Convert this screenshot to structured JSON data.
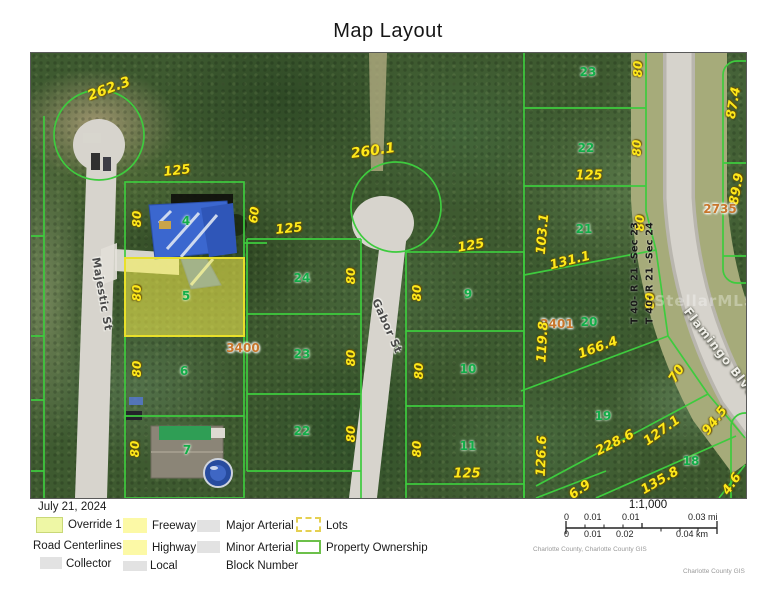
{
  "title": "Map Layout",
  "map": {
    "labels": [
      {
        "t": "262.3",
        "x": 78,
        "y": 36,
        "r": -20,
        "c": "dim",
        "s": 14
      },
      {
        "t": "125",
        "x": 146,
        "y": 118,
        "r": -6,
        "c": "dim",
        "s": 13
      },
      {
        "t": "80",
        "x": 106,
        "y": 166,
        "r": -90,
        "c": "dim"
      },
      {
        "t": "60",
        "x": 223,
        "y": 162,
        "r": -83,
        "c": "dim"
      },
      {
        "t": "4",
        "x": 155,
        "y": 168,
        "r": 0,
        "c": "parcel"
      },
      {
        "t": "80",
        "x": 106,
        "y": 240,
        "r": -90,
        "c": "dim"
      },
      {
        "t": "5",
        "x": 155,
        "y": 243,
        "r": 0,
        "c": "parcel"
      },
      {
        "t": "3400",
        "x": 212,
        "y": 295,
        "r": 0,
        "c": "block"
      },
      {
        "t": "80",
        "x": 106,
        "y": 316,
        "r": -90,
        "c": "dim"
      },
      {
        "t": "6",
        "x": 153,
        "y": 318,
        "r": 0,
        "c": "parcel"
      },
      {
        "t": "80",
        "x": 104,
        "y": 396,
        "r": -90,
        "c": "dim"
      },
      {
        "t": "7",
        "x": 156,
        "y": 397,
        "r": 0,
        "c": "parcel"
      },
      {
        "t": "260.1",
        "x": 342,
        "y": 98,
        "r": -8,
        "c": "dim",
        "s": 14
      },
      {
        "t": "125",
        "x": 258,
        "y": 176,
        "r": -6,
        "c": "dim",
        "s": 13
      },
      {
        "t": "24",
        "x": 271,
        "y": 225,
        "r": 0,
        "c": "parcel"
      },
      {
        "t": "80",
        "x": 320,
        "y": 223,
        "r": -90,
        "c": "dim"
      },
      {
        "t": "23",
        "x": 271,
        "y": 301,
        "r": 0,
        "c": "parcel"
      },
      {
        "t": "80",
        "x": 320,
        "y": 305,
        "r": -90,
        "c": "dim"
      },
      {
        "t": "22",
        "x": 271,
        "y": 378,
        "r": 0,
        "c": "parcel"
      },
      {
        "t": "80",
        "x": 320,
        "y": 381,
        "r": -90,
        "c": "dim"
      },
      {
        "t": "125",
        "x": 440,
        "y": 193,
        "r": -10,
        "c": "dim",
        "s": 13
      },
      {
        "t": "9",
        "x": 437,
        "y": 241,
        "r": 0,
        "c": "parcel"
      },
      {
        "t": "80",
        "x": 386,
        "y": 240,
        "r": -90,
        "c": "dim"
      },
      {
        "t": "10",
        "x": 437,
        "y": 316,
        "r": 0,
        "c": "parcel"
      },
      {
        "t": "80",
        "x": 388,
        "y": 318,
        "r": -90,
        "c": "dim"
      },
      {
        "t": "11",
        "x": 437,
        "y": 393,
        "r": 0,
        "c": "parcel"
      },
      {
        "t": "80",
        "x": 386,
        "y": 396,
        "r": -90,
        "c": "dim"
      },
      {
        "t": "125",
        "x": 436,
        "y": 421,
        "r": 0,
        "c": "dim",
        "s": 13
      },
      {
        "t": "23",
        "x": 557,
        "y": 19,
        "r": 0,
        "c": "parcel"
      },
      {
        "t": "80",
        "x": 607,
        "y": 16,
        "r": -90,
        "c": "dim"
      },
      {
        "t": "22",
        "x": 555,
        "y": 95,
        "r": 0,
        "c": "parcel"
      },
      {
        "t": "80",
        "x": 606,
        "y": 95,
        "r": -90,
        "c": "dim"
      },
      {
        "t": "125",
        "x": 558,
        "y": 123,
        "r": 0,
        "c": "dim",
        "s": 13
      },
      {
        "t": "21",
        "x": 553,
        "y": 176,
        "r": 0,
        "c": "parcel"
      },
      {
        "t": "103.1",
        "x": 512,
        "y": 181,
        "r": -85,
        "c": "dim",
        "s": 13
      },
      {
        "t": "131.1",
        "x": 539,
        "y": 208,
        "r": -14,
        "c": "dim",
        "s": 13
      },
      {
        "t": "80",
        "x": 609,
        "y": 170,
        "r": -90,
        "c": "dim"
      },
      {
        "t": "80",
        "x": 619,
        "y": 248,
        "r": -90,
        "c": "dim"
      },
      {
        "t": "20",
        "x": 558,
        "y": 269,
        "r": 0,
        "c": "parcel"
      },
      {
        "t": "3401",
        "x": 526,
        "y": 271,
        "r": 0,
        "c": "block"
      },
      {
        "t": "119.8",
        "x": 512,
        "y": 289,
        "r": -87,
        "c": "dim",
        "s": 13
      },
      {
        "t": "166.4",
        "x": 567,
        "y": 295,
        "r": -20,
        "c": "dim",
        "s": 13
      },
      {
        "t": "70",
        "x": 646,
        "y": 321,
        "r": -58,
        "c": "dim",
        "s": 13
      },
      {
        "t": "19",
        "x": 572,
        "y": 363,
        "r": 0,
        "c": "parcel"
      },
      {
        "t": "126.6",
        "x": 511,
        "y": 403,
        "r": -88,
        "c": "dim",
        "s": 13
      },
      {
        "t": "228.6",
        "x": 584,
        "y": 390,
        "r": -27,
        "c": "dim",
        "s": 13
      },
      {
        "t": "127.1",
        "x": 631,
        "y": 378,
        "r": -36,
        "c": "dim",
        "s": 13
      },
      {
        "t": "94.5",
        "x": 684,
        "y": 368,
        "r": -52,
        "c": "dim",
        "s": 13
      },
      {
        "t": "18",
        "x": 660,
        "y": 408,
        "r": 0,
        "c": "parcel"
      },
      {
        "t": "135.8",
        "x": 629,
        "y": 428,
        "r": -30,
        "c": "dim",
        "s": 13
      },
      {
        "t": "6.9",
        "x": 549,
        "y": 437,
        "r": -35,
        "c": "dim",
        "s": 13
      },
      {
        "t": "4.6",
        "x": 701,
        "y": 431,
        "r": -55,
        "c": "dim",
        "s": 13
      },
      {
        "t": "87.4",
        "x": 703,
        "y": 50,
        "r": -80,
        "c": "dim",
        "s": 13
      },
      {
        "t": "89.9",
        "x": 706,
        "y": 136,
        "r": -80,
        "c": "dim",
        "s": 13
      },
      {
        "t": "2735",
        "x": 689,
        "y": 156,
        "r": 0,
        "c": "block"
      },
      {
        "t": "Majestic St",
        "x": 71,
        "y": 241,
        "r": 80,
        "c": "street"
      },
      {
        "t": "Gabor St",
        "x": 356,
        "y": 273,
        "r": 66,
        "c": "street"
      },
      {
        "t": "Flamingo Blvd",
        "x": 689,
        "y": 299,
        "r": 52,
        "c": "flamingo"
      },
      {
        "t": "T 40- R 21 -Sec 23",
        "x": 604,
        "y": 220,
        "r": -90,
        "c": "section"
      },
      {
        "t": "T 40- R 21 -Sec 24",
        "x": 619,
        "y": 220,
        "r": -90,
        "c": "section"
      },
      {
        "t": "StellarMLS",
        "x": 674,
        "y": 248,
        "r": 0,
        "c": "wm"
      }
    ]
  },
  "legend": {
    "date": "July 21, 2024",
    "heading": "Road Centerlines",
    "items": [
      {
        "label": "Override 1",
        "sw": "override",
        "sx": 36,
        "sy": 517,
        "w": 27,
        "h": 16,
        "lx": 68,
        "ly": 519
      },
      {
        "label": "Freeway",
        "sw": "yellow",
        "sx": 123,
        "sy": 518,
        "w": 24,
        "h": 15,
        "lx": 152,
        "ly": 520
      },
      {
        "label": "Major Arterial",
        "sw": "gray",
        "sx": 197,
        "sy": 520,
        "w": 23,
        "h": 12,
        "lx": 226,
        "ly": 520
      },
      {
        "label": "Lots",
        "sw": "lots",
        "sx": 296,
        "sy": 517,
        "w": 25,
        "h": 15,
        "lx": 326,
        "ly": 520
      },
      {
        "label": "Highway",
        "sw": "yellow",
        "sx": 123,
        "sy": 540,
        "w": 24,
        "h": 15,
        "lx": 152,
        "ly": 542
      },
      {
        "label": "Minor Arterial",
        "sw": "gray",
        "sx": 197,
        "sy": 541,
        "w": 23,
        "h": 12,
        "lx": 226,
        "ly": 542
      },
      {
        "label": "Property Ownership",
        "sw": "ownership",
        "sx": 296,
        "sy": 540,
        "w": 25,
        "h": 14,
        "lx": 326,
        "ly": 542
      },
      {
        "label": "Collector",
        "sw": "gray",
        "sx": 40,
        "sy": 557,
        "w": 22,
        "h": 12,
        "lx": 66,
        "ly": 558
      },
      {
        "label": "Local",
        "sw": "gray",
        "sx": 123,
        "sy": 561,
        "w": 24,
        "h": 10,
        "lx": 150,
        "ly": 560
      },
      {
        "label": "Block Number",
        "sw": "none",
        "sx": 0,
        "sy": 0,
        "w": 0,
        "h": 0,
        "lx": 226,
        "ly": 560
      }
    ]
  },
  "scale": {
    "ratio": "1:1,000",
    "mi_labels": [
      {
        "t": "0",
        "x": 6
      },
      {
        "t": "0.01",
        "x": 26
      },
      {
        "t": "0.01",
        "x": 64
      },
      {
        "t": "0.03 mi",
        "x": 130
      }
    ],
    "km_labels": [
      {
        "t": "0",
        "x": 6
      },
      {
        "t": "0.01",
        "x": 26
      },
      {
        "t": "0.02",
        "x": 58
      },
      {
        "t": "0.04 km",
        "x": 118
      }
    ]
  },
  "attribution": {
    "left": "Charlotte County, Charlotte County GIS",
    "right": "Charlotte County GIS"
  },
  "colors": {
    "parcel_line": "#3ecb3e",
    "highlight_fill": "rgba(250,242,80,0.55)",
    "highlight_border": "#e8e02a",
    "dim_label": "#ffe81a",
    "parcel_label": "#13ad49",
    "block_label": "#c8762c",
    "road": "#d7d4cd"
  }
}
